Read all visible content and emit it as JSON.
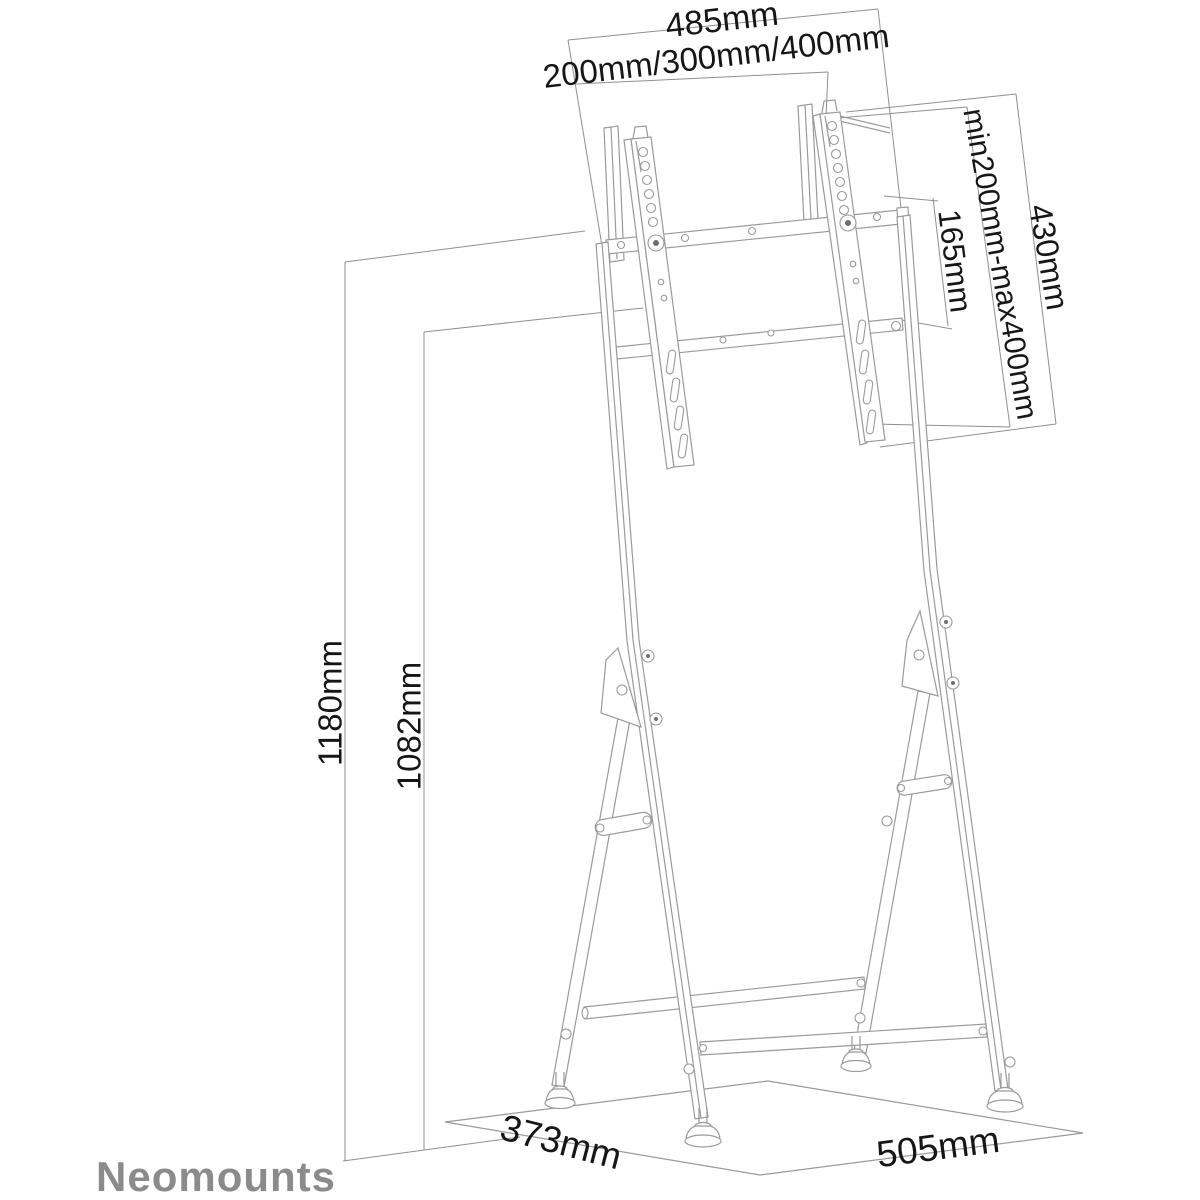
{
  "brand": {
    "name": "Neomounts",
    "color": "#8b8b8b"
  },
  "colors": {
    "structure_line": "#9a9a9a",
    "dimension_line": "#8f8f8f",
    "text": "#161616",
    "background": "#ffffff"
  },
  "dims": {
    "top_width": "485mm",
    "vesa_width": "200mm/300mm/400mm",
    "vesa_range": "min200mm-max400mm",
    "bracket_height": "430mm",
    "crossbar_gap": "165mm",
    "overall_height": "1180mm",
    "frame_height": "1082mm",
    "base_depth": "373mm",
    "base_width": "505mm"
  }
}
